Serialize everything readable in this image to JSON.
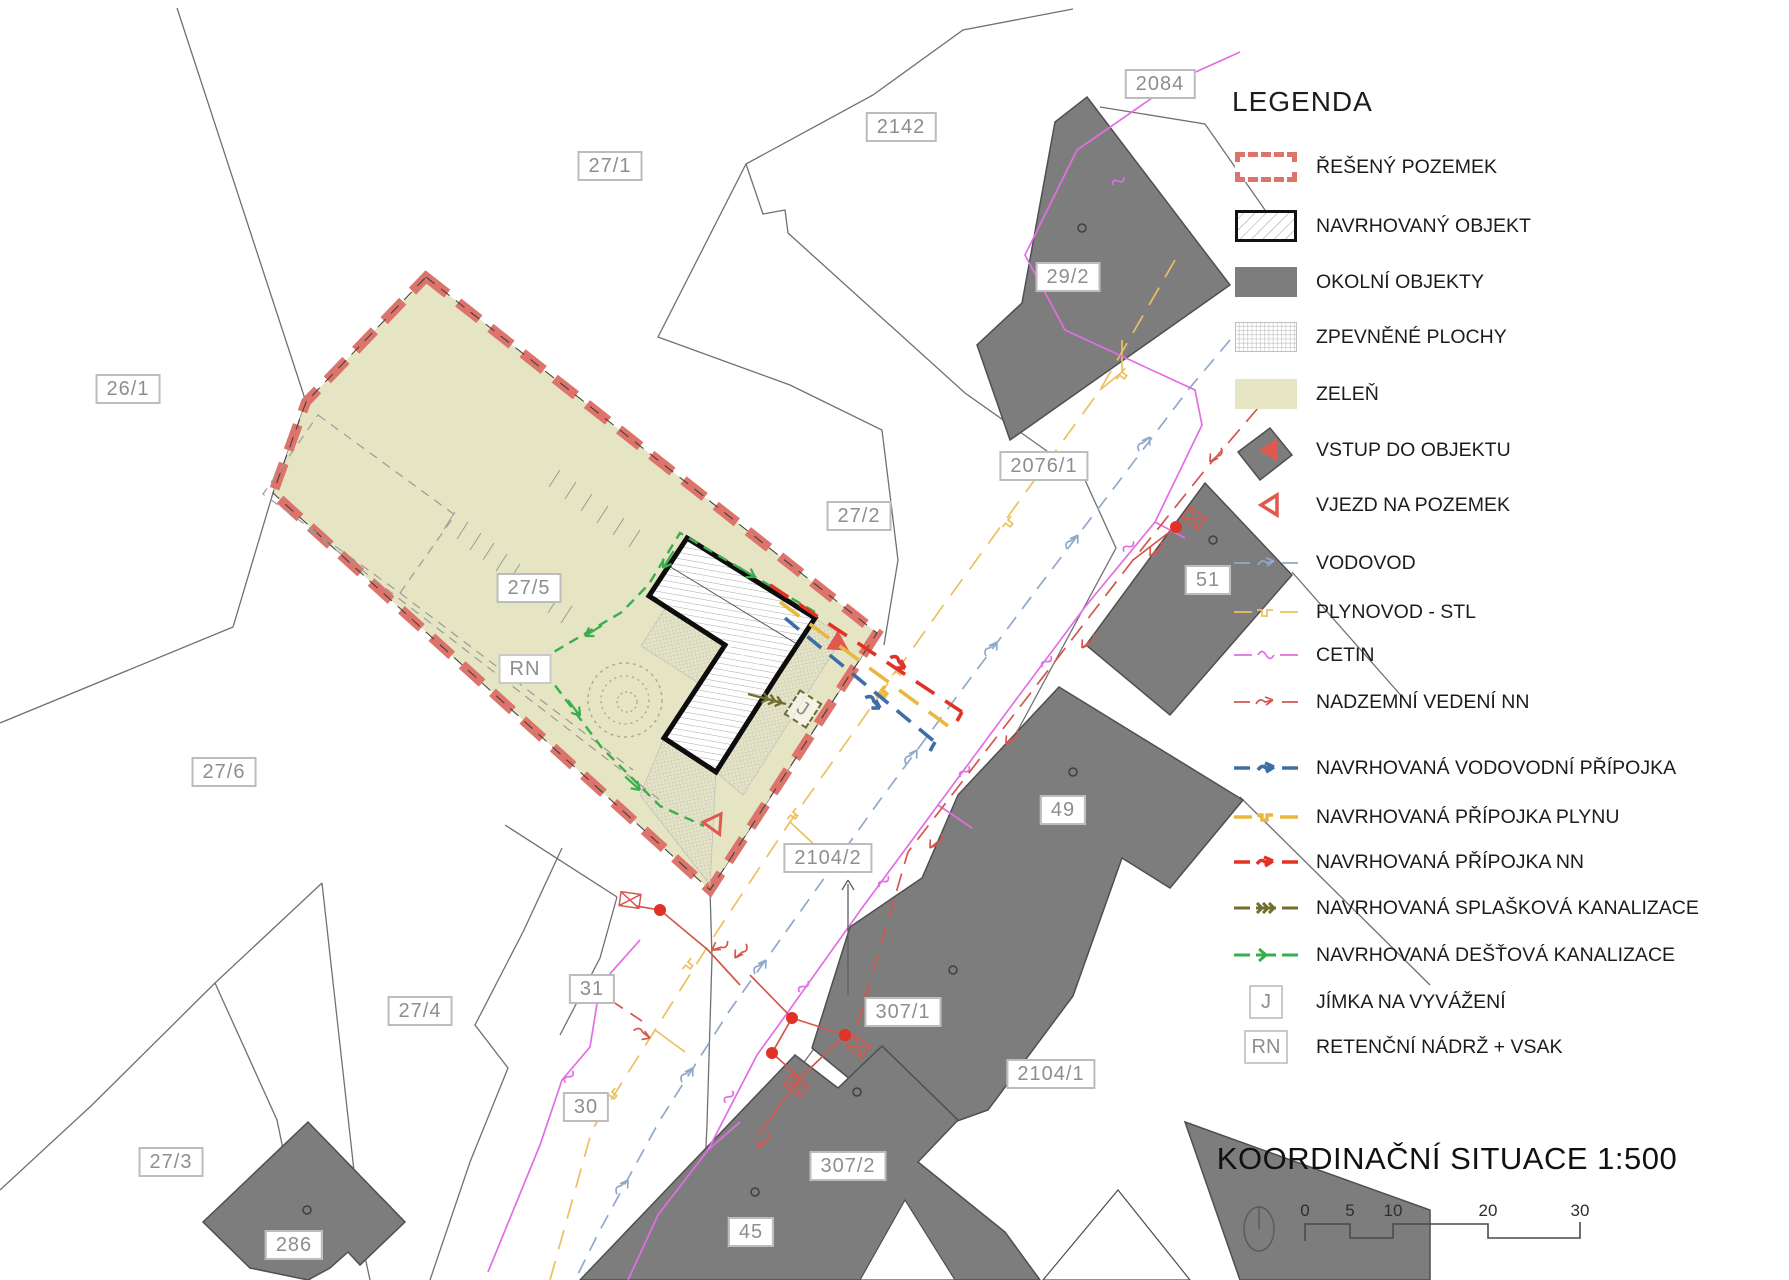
{
  "map": {
    "parcel_labels": [
      {
        "id": "26-1",
        "text": "26/1"
      },
      {
        "id": "27-1",
        "text": "27/1"
      },
      {
        "id": "2142",
        "text": "2142"
      },
      {
        "id": "2084",
        "text": "2084"
      },
      {
        "id": "29-2",
        "text": "29/2"
      },
      {
        "id": "2076-1",
        "text": "2076/1"
      },
      {
        "id": "27-2",
        "text": "27/2"
      },
      {
        "id": "51",
        "text": "51"
      },
      {
        "id": "27-5",
        "text": "27/5"
      },
      {
        "id": "27-6",
        "text": "27/6"
      },
      {
        "id": "49",
        "text": "49"
      },
      {
        "id": "2104-2",
        "text": "2104/2"
      },
      {
        "id": "27-4",
        "text": "27/4"
      },
      {
        "id": "31",
        "text": "31"
      },
      {
        "id": "307-1",
        "text": "307/1"
      },
      {
        "id": "2104-1",
        "text": "2104/1"
      },
      {
        "id": "30",
        "text": "30"
      },
      {
        "id": "27-3",
        "text": "27/3"
      },
      {
        "id": "307-2",
        "text": "307/2"
      },
      {
        "id": "286",
        "text": "286"
      },
      {
        "id": "45",
        "text": "45"
      }
    ],
    "markers": {
      "retention": "RN",
      "sump": "J"
    }
  },
  "legend": {
    "title": "LEGENDA",
    "items": [
      {
        "label": "ŘEŠENÝ POZEMEK",
        "type": "red-dashed-parcel"
      },
      {
        "label": "NAVRHOVANÝ OBJEKT",
        "type": "hatched-building"
      },
      {
        "label": "OKOLNÍ OBJEKTY",
        "type": "gray-building"
      },
      {
        "label": "ZPEVNĚNÉ PLOCHY",
        "type": "crosshatch-paving"
      },
      {
        "label": "ZELEŇ",
        "type": "green-area"
      },
      {
        "label": "VSTUP DO OBJEKTU",
        "type": "filled-triangle"
      },
      {
        "label": "VJEZD NA POZEMEK",
        "type": "outline-triangle"
      },
      {
        "label": "VODOVOD",
        "type": "water-existing"
      },
      {
        "label": "PLYNOVOD - STL",
        "type": "gas-existing"
      },
      {
        "label": "CETIN",
        "type": "cetin"
      },
      {
        "label": "NADZEMNÍ VEDENÍ NN",
        "type": "nn-overhead"
      },
      {
        "label": "NAVRHOVANÁ VODOVODNÍ PŘÍPOJKA",
        "type": "water-proposed"
      },
      {
        "label": "NAVRHOVANÁ PŘÍPOJKA PLYNU",
        "type": "gas-proposed"
      },
      {
        "label": "NAVRHOVANÁ PŘÍPOJKA NN",
        "type": "nn-proposed"
      },
      {
        "label": "NAVRHOVANÁ SPLAŠKOVÁ KANALIZACE",
        "type": "sewer-proposed"
      },
      {
        "label": "NAVRHOVANÁ DEŠŤOVÁ KANALIZACE",
        "type": "storm-proposed"
      },
      {
        "label": "JÍMKA NA VYVÁŽENÍ",
        "type": "sump-symbol",
        "symbol": "J"
      },
      {
        "label": "RETENČNÍ NÁDRŽ + VSAK",
        "type": "retention-symbol",
        "symbol": "RN"
      }
    ]
  },
  "title_block": {
    "title": "KOORDINAČNÍ SITUACE 1:500",
    "scale_ticks": [
      "0",
      "5",
      "10",
      "20",
      "30"
    ]
  },
  "colors": {
    "parcel_boundary_red": "#dd746b",
    "green_area": "#e6e5c3",
    "surrounding_building_gray": "#7d7d7d",
    "water": "#8fa9cb",
    "water_proposed": "#3e6fa4",
    "gas": "#ebc05f",
    "gas_proposed": "#e9b93f",
    "cetin_magenta": "#e36ee3",
    "nn_red": "#d2574e",
    "nn_proposed": "#e03226",
    "sewer_olive": "#716f2f",
    "storm_green": "#3bad4e"
  }
}
